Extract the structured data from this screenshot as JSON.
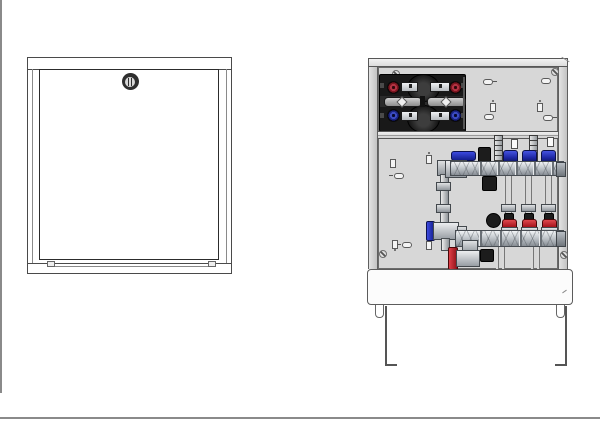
{
  "document": {
    "type": "technical product drawing",
    "subject": "Underfloor-heating manifold cabinet shown in two views: closed front view and open view with internal components",
    "visible_text": ""
  },
  "views": {
    "closed": {
      "name": "Closed cabinet front view",
      "parts": {
        "frame": "cabinet frame",
        "door": "door panel",
        "lock": "cam lock",
        "feet_notches": 2
      }
    },
    "open": {
      "name": "Open cabinet internal view",
      "parts": {
        "top_rail": "cabinet top rail",
        "back_panel": "mounting back panel",
        "heat_meter_assembly": "insulated twin heat-meter unit with red and blue shut-off handwheels",
        "mounting_rail": "horizontal manifold mounting rail",
        "flow_manifold": "upper stainless flow manifold with blue loop caps",
        "return_manifold": "lower stainless return manifold with red loop caps",
        "flow_meters": "vertical flow-meter sight tubes",
        "supply_riser": "left vertical riser with blue lever ball valve",
        "drain_valve": "red lever drain/fill valve",
        "plinth": "bottom cover plate",
        "legs": "height-adjustable frame legs"
      }
    }
  },
  "counts": {
    "manifold_loops": 3,
    "blue_flow_caps": 3,
    "red_return_caps": 3,
    "red_handwheels": 2,
    "blue_handwheels": 2,
    "flow_meter_tubes": 2,
    "mounting_holes": 12,
    "screws": 4
  },
  "colors": {
    "page_border": "#8a8a8a",
    "drawing_line": "#4a4a4a",
    "back_panel": "#d7d7d7",
    "heat_meter_shell": "#191919",
    "red_accent": "#a81c24",
    "blue_accent": "#2433b8",
    "steel_light": "#eef0f2",
    "steel_dark": "#8f959b",
    "plinth": "#fcfcfc"
  }
}
